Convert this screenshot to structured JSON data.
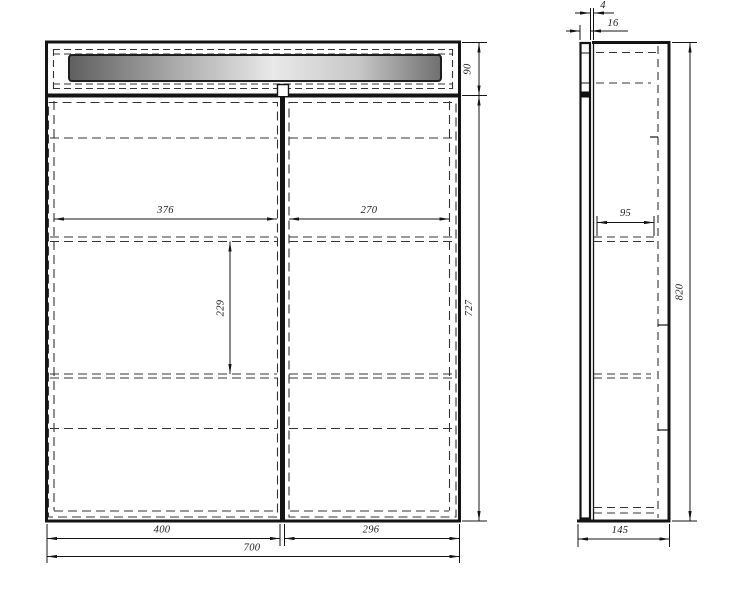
{
  "drawing": {
    "kind": "furniture-technical-drawing",
    "front": {
      "inner_left_width": "376",
      "inner_right_width": "270",
      "shelf_span_height": "229",
      "top_section_height": "90",
      "door_section_height": "727",
      "left_door_width": "400",
      "right_door_width": "296",
      "total_width": "700"
    },
    "side": {
      "front_gap": "4",
      "panel_thickness": "16",
      "shelf_depth": "95",
      "total_height": "820",
      "total_depth": "145"
    },
    "colors": {
      "line": "#141414",
      "dashed_line": "#333333",
      "background": "#ffffff",
      "light_bar_dark": "#636363",
      "light_bar_bright": "#ededed"
    }
  }
}
